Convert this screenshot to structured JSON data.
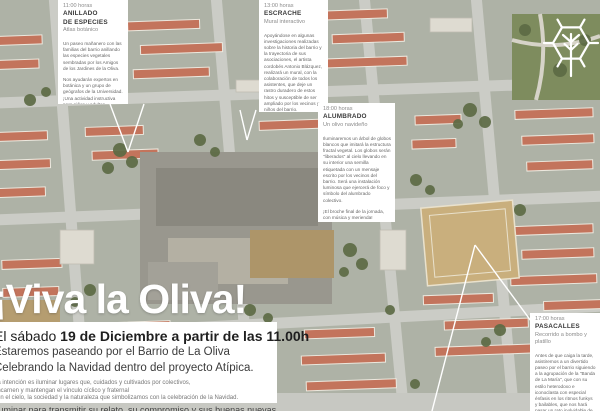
{
  "poster": {
    "title": "¡Viva la Oliva!",
    "date_prefix": "El sábado ",
    "date_bold": "19 de Diciembre a partir de las 11.00h",
    "line2": "Estaremos paseando por el Barrio de La Oliva",
    "line3": "Celebrando la Navidad dentro del proyecto Atípica.",
    "fine_print": [
      "La intención es iluminar lugares que, cuidados y cultivados por colectivos,",
      "encarnen y mantengan el vínculo cíclico y fraternal",
      "con el cielo, la sociedad y la naturaleza que simbolizamos con la celebración de la Navidad."
    ],
    "closing_line": "Iluminar para transmitir su relato, su compromiso y sus buenas nuevas."
  },
  "events": [
    {
      "time": "11:00 horas",
      "name": "ANILLADO\nDE ESPECIES",
      "subtitle": "Atlas botánico",
      "body": [
        "Un paseo mañanero con las familias del barrio anillando las especies vegetales sembradas por los Amigos de los Jardines de la Oliva.",
        "Nos ayudarán expertos en botánica y un grupo de geógrafos de la Universidad. ¡Una actividad instructiva para niños y adultos amantes de la Naturaleza y la Tecnología!"
      ]
    },
    {
      "time": "13:00 horas",
      "name": "ESCRACHE",
      "subtitle": "Mural interactivo",
      "body": [
        "Apoyándose en algunas investigaciones realizadas sobre la historia del barrio y la trayectoria de sus asociaciones, el artista cordobés Antonio Blázquez, realizará un mural, con la colaboración de todos los asistentes, que deje un rastro duradero de estos hitos y susceptible de ser ampliado por los vecinos y niños del barrio.",
        "Street Art!"
      ]
    },
    {
      "time": "18:00 horas",
      "name": "ALUMBRADO",
      "subtitle": "Un olivo navideño",
      "body": [
        "Iluminaremos un árbol de globos blancos que imitará la estructura fractal vegetal. Los globos serán \"liberados\" al cielo llevando en su interior una semilla etiquetada con un mensaje escrito por los vecinos del barrio. Será una instalación luminosa que ejercerá de foco y símbolo del alumbrado colectivo.",
        "¡El broche final de la jornada, con música y merienda!"
      ]
    },
    {
      "time": "17:00 horas",
      "name": "PASACALLES",
      "subtitle": "Recorrido a bombo y platillo",
      "body": [
        "Antes de que caiga la tarde, asistiremos a un divertido paseo por el barrio siguiendo a la agrupación de la \"Banda de La María\", que con su estilo heterodoxo e iconoclasta con especial énfasis en los ritmos funkys y bailables, que nos hará pasar un rato inolvidable de música y"
      ]
    }
  ],
  "logo": {
    "icon": "hexagon-tree-logo"
  },
  "colors": {
    "panel_bg": "#ffffff",
    "heading_text": "#3a3a3a",
    "muted_text": "#8b8b8b",
    "body_text": "#666666",
    "title_text": "#ffffff",
    "roof_red": "#c3745c",
    "street_gray": "#cbccc6",
    "vegetation_green": "#5d6b45"
  }
}
